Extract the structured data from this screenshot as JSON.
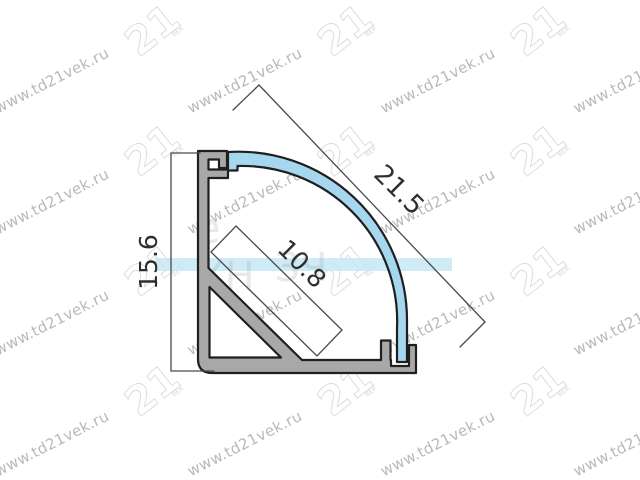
{
  "canvas": {
    "width": 640,
    "height": 480,
    "background": "#ffffff"
  },
  "colors": {
    "profile_gray": "#a8a8a8",
    "cavity_white": "#ffffff",
    "diffuser_blue": "#a5d8ee",
    "outline_dark": "#1f1f1f",
    "dimension_line": "#4a4a4a",
    "ghost_band_blue": "#c6e7f5",
    "watermark_gray": "#a9afb4",
    "logo_outline_gray": "#d7dadd"
  },
  "dim_labels": {
    "height": "15.6",
    "diagonal": "21.5",
    "led_area": "10.8"
  },
  "watermark": {
    "url_text": "www.td21vek.ru",
    "logo_text": "21",
    "logo_subtext": "ВЕК",
    "text_positions": [
      [
        54,
        85
      ],
      [
        247,
        85
      ],
      [
        440,
        85
      ],
      [
        633,
        85
      ],
      [
        54,
        206
      ],
      [
        247,
        206
      ],
      [
        440,
        206
      ],
      [
        633,
        206
      ],
      [
        54,
        327
      ],
      [
        247,
        327
      ],
      [
        440,
        327
      ],
      [
        633,
        327
      ],
      [
        54,
        448
      ],
      [
        247,
        448
      ],
      [
        440,
        448
      ],
      [
        633,
        448
      ]
    ],
    "logo_positions": [
      [
        152,
        30
      ],
      [
        345,
        30
      ],
      [
        538,
        30
      ],
      [
        152,
        150
      ],
      [
        345,
        150
      ],
      [
        538,
        150
      ],
      [
        152,
        270
      ],
      [
        345,
        270
      ],
      [
        538,
        270
      ],
      [
        152,
        390
      ],
      [
        345,
        390
      ],
      [
        538,
        390
      ]
    ],
    "ghost_band": {
      "x": 155,
      "y": 258,
      "w": 297,
      "h": 13
    },
    "ghost_fragments": [
      {
        "text": "е",
        "x": 207,
        "y": 243,
        "size": 44
      },
      {
        "text": "ХН",
        "x": 226,
        "y": 290,
        "size": 40
      },
      {
        "text": "ЗЧ",
        "x": 301,
        "y": 281,
        "size": 40
      }
    ]
  }
}
